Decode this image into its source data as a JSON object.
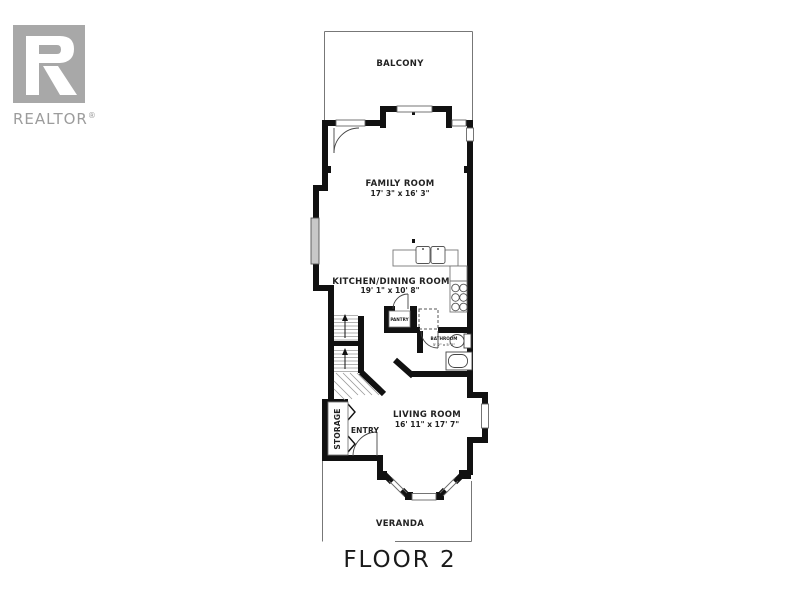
{
  "logo": {
    "brand": "REALTOR",
    "registered": "®"
  },
  "plan": {
    "floor_label": "FLOOR 2",
    "rooms": {
      "balcony": {
        "name": "BALCONY"
      },
      "family_room": {
        "name": "FAMILY ROOM",
        "dims": "17' 3\" x 16' 3\""
      },
      "kitchen_dining": {
        "name": "KITCHEN/DINING ROOM",
        "dims": "19' 1\" x 10' 8\""
      },
      "pantry": {
        "name": "PANTRY"
      },
      "bathroom": {
        "name": "BATHROOM",
        "dims": "5' 2\" x 5' 2\""
      },
      "living_room": {
        "name": "LIVING ROOM",
        "dims": "16' 11\" x 17' 7\""
      },
      "entry": {
        "name": "ENTRY"
      },
      "storage": {
        "name": "STORAGE"
      },
      "veranda": {
        "name": "VERANDA"
      }
    },
    "colors": {
      "wall": "#111111",
      "thin_line": "#777777",
      "window_fill": "#c8c8c8",
      "label": "#222222",
      "logo_gray": "#a8a8a8"
    }
  }
}
